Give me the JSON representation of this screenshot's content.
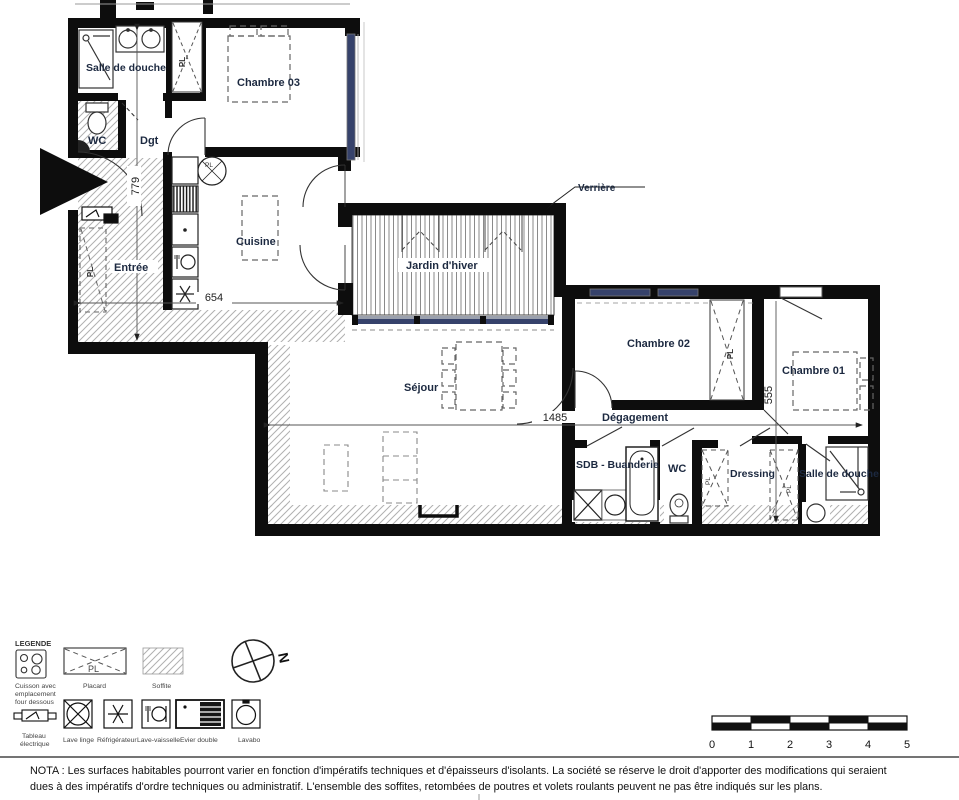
{
  "plan": {
    "rooms": {
      "salle_de_douche_1": "Salle de douche",
      "wc_1": "WC",
      "dgt": "Dgt",
      "chambre_03": "Chambre 03",
      "cuisine": "Cuisine",
      "entree": "Entrée",
      "jardin_hiver": "Jardin d'hiver",
      "sejour": "Séjour",
      "chambre_02": "Chambre 02",
      "chambre_01": "Chambre 01",
      "degagement": "Dégagement",
      "sdb_buanderie": "SDB - Buanderie",
      "wc_2": "WC",
      "dressing": "Dressing",
      "salle_de_douche_2": "Salle de douche"
    },
    "annotations": {
      "verriere": "Verrière",
      "placard_abbr": "PL"
    },
    "dimensions": {
      "entree_depth": "779",
      "cuisine_width": "654",
      "sejour_width": "1485",
      "chambre_01_depth": "555"
    }
  },
  "legend": {
    "title": "LEGENDE",
    "cuisson": [
      "Cuisson avec",
      "emplacement",
      "four dessous"
    ],
    "placard": "Placard",
    "placard_symbol": "PL",
    "soffite": "Soffite",
    "tableau": [
      "Tableau",
      "électrique"
    ],
    "lave_linge": "Lave linge",
    "refrigerateur": "Réfrigérateur",
    "lave_vaisselle": "Lave-vaisselle",
    "evier_double": "Evier double",
    "lavabo": "Lavabo"
  },
  "compass": {
    "north": "N"
  },
  "scale_bar": {
    "ticks": [
      "0",
      "1",
      "2",
      "3",
      "4",
      "5"
    ]
  },
  "nota": {
    "line1": "NOTA : Les surfaces habitables pourront varier en fonction d'impératifs techniques et d'épaisseurs d'isolants. La société se réserve le droit d'apporter des modifications qui seraient",
    "line2": "dues à des impératifs d'ordre techniques ou administratif. L'ensemble des soffites, retombées de poutres et volets roulants peuvent ne pas être indiqués sur les plans."
  },
  "colors": {
    "wall": "#0d0d0d",
    "window_glass": "#36426b",
    "soffite_hatch": "#b0b0b0",
    "room_label": "#1c2940"
  }
}
